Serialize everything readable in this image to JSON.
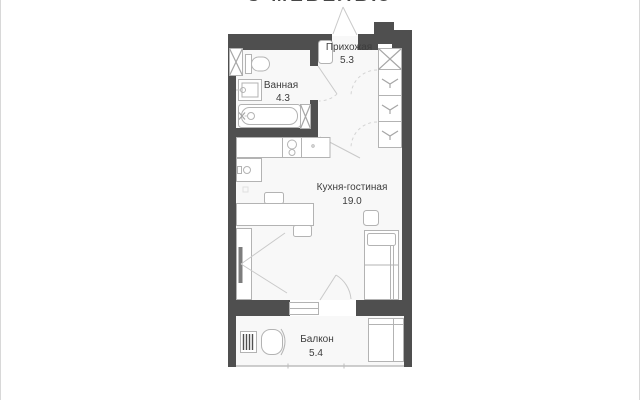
{
  "title": {
    "text": "С МЕБЕЛЬЮ"
  },
  "floor_plan": {
    "rooms": [
      {
        "id": "hallway",
        "name": "Прихожая",
        "area": "5.3"
      },
      {
        "id": "bathroom",
        "name": "Ванная",
        "area": "4.3"
      },
      {
        "id": "kitchen_living",
        "name": "Кухня-гостиная",
        "area": "19.0"
      },
      {
        "id": "balcony",
        "name": "Балкон",
        "area": "5.4"
      }
    ],
    "icons": {
      "wardrobe_hanger": "hanger-icon",
      "ventilation_shaft": "x-cross-icon"
    },
    "colors": {
      "wall": "#4f4f4f",
      "furniture_line": "#b3b3b3",
      "room_fill": "#f8f8f8",
      "label_text": "#3d3d3d"
    }
  }
}
